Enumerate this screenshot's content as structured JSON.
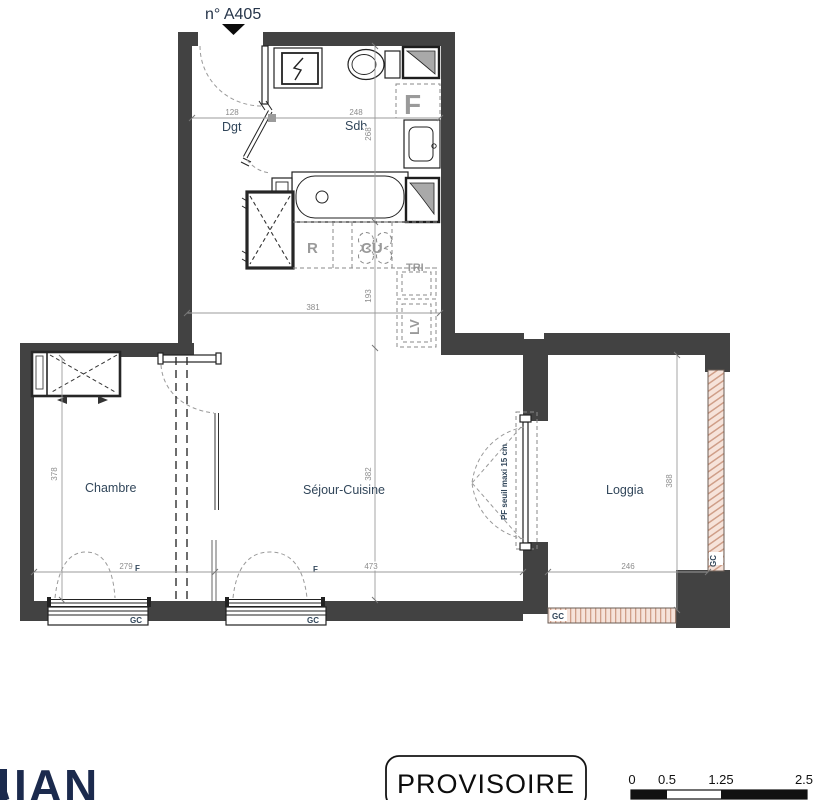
{
  "unit": {
    "number": "n° A405"
  },
  "rooms": {
    "dgt": "Dgt",
    "sdb": "Sdb",
    "chambre": "Chambre",
    "sejour_cuisine": "Séjour-Cuisine",
    "loggia": "Loggia"
  },
  "dimensions": {
    "dgt_width": "128",
    "sdb_width": "248",
    "sdb_depth": "268",
    "kitchen_depth": "193",
    "kitchen_width": "381",
    "sejour_depth": "382",
    "chambre_width": "279",
    "chambre_depth": "378",
    "sejour_width": "473",
    "loggia_width": "246",
    "loggia_depth": "388"
  },
  "appliances": {
    "fridge": "R",
    "cooktop": "CU",
    "sorting": "TRI",
    "dishwasher": "LV",
    "bath_fixture": "F"
  },
  "openings": {
    "window1_label": "F",
    "window2_label": "F",
    "window1_guardrail": "GC",
    "window2_guardrail": "GC",
    "loggia_guardrail_bottom": "GC",
    "loggia_guardrail_right": "GC",
    "pf_note": "PF  seuil maxi 15 cm"
  },
  "stamp": {
    "label": "PROVISOIRE"
  },
  "scale_bar": {
    "ticks": [
      "0",
      "0.5",
      "1.25",
      "2.5"
    ]
  },
  "logo": {
    "text": "IAN"
  },
  "colors": {
    "wall": "#424242",
    "room_label": "#31465a",
    "dim": "#8c8c8c",
    "logo": "#1b2a4d",
    "hatch_bg": "#f6e3da",
    "hatch_stripe": "#cf9e88"
  }
}
